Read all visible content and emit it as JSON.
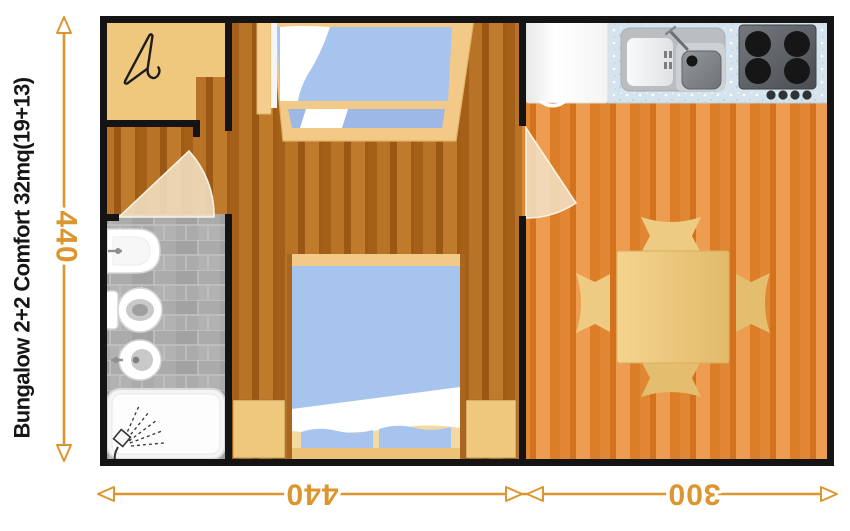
{
  "title": {
    "text": "Bungalow 2+2 Comfort 32mq(19+13)"
  },
  "dimensions": {
    "height_cm": "440",
    "width_left_cm": "440",
    "width_right_cm": "300",
    "unit_note": "orange dimension arrows with open triangular heads; bottom labels drawn upside-down"
  },
  "plan": {
    "rooms": [
      "entry-closet",
      "bathroom",
      "bedroom-hall",
      "kitchen-dining"
    ],
    "furniture": [
      "coat-closet",
      "bunk-bed",
      "double-bed",
      "nightstand-left",
      "nightstand-right",
      "bath-sink",
      "toilet",
      "bidet",
      "shower-tray",
      "fridge",
      "kitchen-counter",
      "kitchen-sink",
      "stove-4-burners",
      "dining-table",
      "chair-top",
      "chair-right",
      "chair-bottom",
      "chair-left",
      "door-bathroom",
      "door-kitchen"
    ],
    "icons": [
      "coat-hanger-icon",
      "shower-spray-icon"
    ]
  },
  "colors": {
    "accent": "#dc962f",
    "walls": "#141414",
    "title_text": "#161616",
    "bedroom_floor": "#b06a1e",
    "kitchen_floor": "#e08531",
    "cabinetry_tan": "#f0c87d",
    "mattress_blue": "#a7c4ef",
    "bathroom_tile": "#ababab",
    "counter_blue": "#d4e3ed",
    "fixture_white": "#ffffff"
  }
}
